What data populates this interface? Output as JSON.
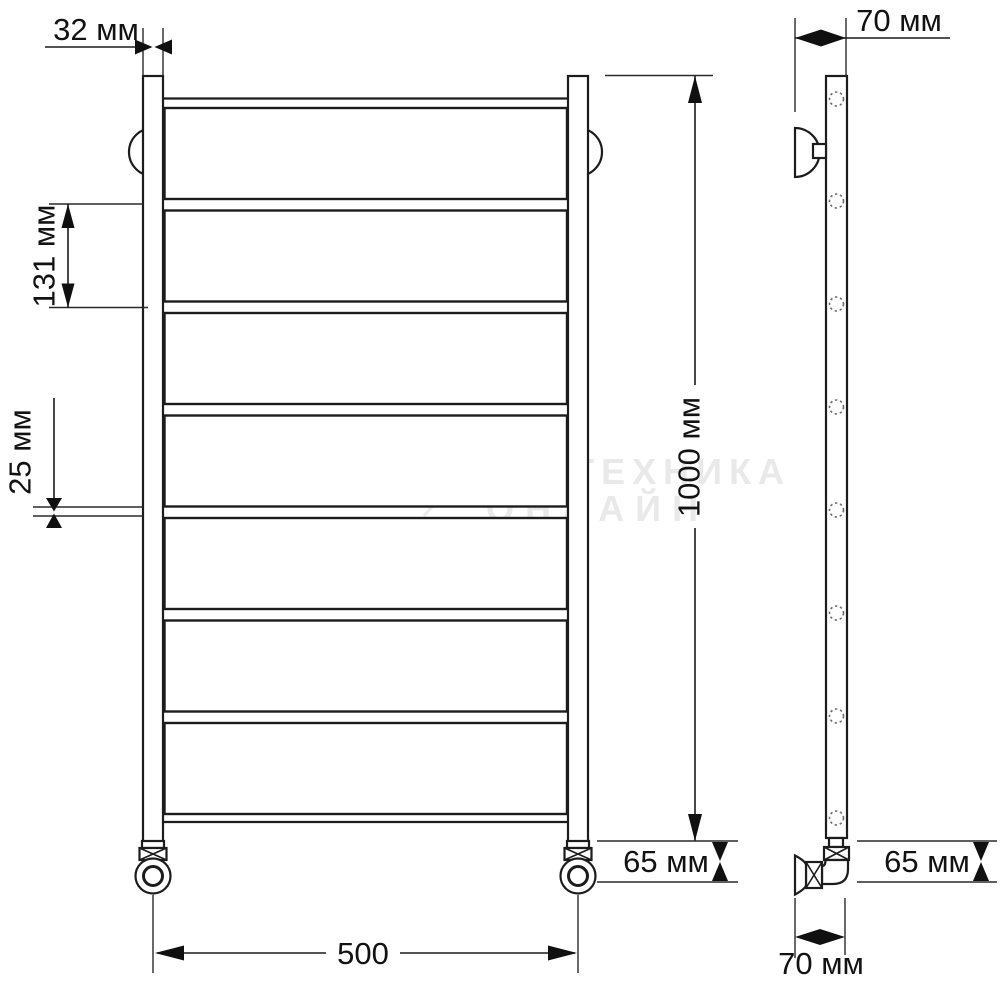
{
  "diagram": {
    "type": "technical-drawing",
    "subject": "ladder-style heated towel rail, front view and side view with dimensions",
    "units": "mm"
  },
  "dims": {
    "d32": "32 мм",
    "d131": "131 мм",
    "d25": "25 мм",
    "d1000": "1000 мм",
    "d500": "500",
    "d65_left": "65 мм",
    "d65_right": "65 мм",
    "d70_top": "70 мм",
    "d70_bottom": "70 мм"
  },
  "watermark": {
    "line1": "САНТЕХНИКА",
    "line2": "ОНЛАЙН"
  },
  "colors": {
    "line": "#1c1c1c",
    "dimension_text": "#121212",
    "watermark": "#e9e9e9",
    "background": "#ffffff"
  }
}
